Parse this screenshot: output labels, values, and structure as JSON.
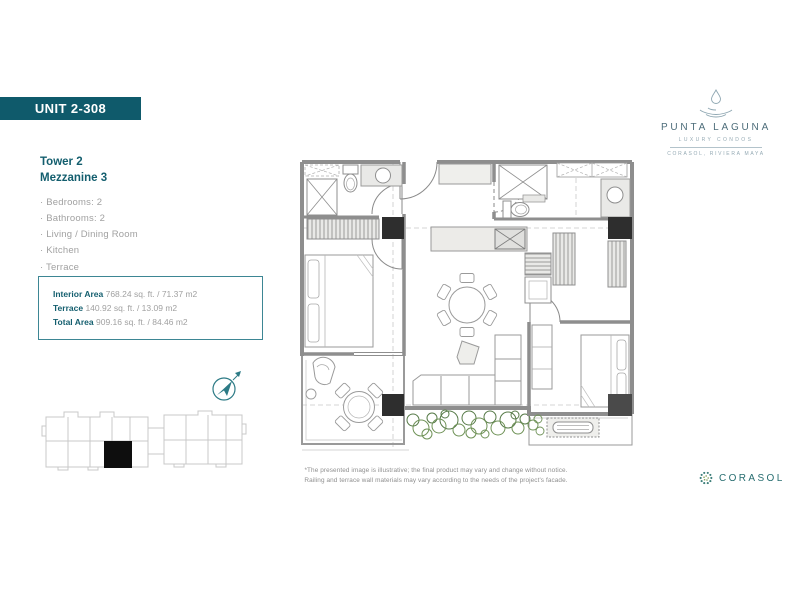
{
  "banner": {
    "label": "UNIT 2-308"
  },
  "brand": {
    "name": "PUNTA LAGUNA",
    "tagline": "LUXURY CONDOS",
    "location": "CORASOL, RIVIERA MAYA"
  },
  "unit_info": {
    "tower": "Tower 2",
    "level": "Mezzanine 3",
    "features": [
      "Bedrooms: 2",
      "Bathrooms: 2",
      "Living / Dining Room",
      "Kitchen",
      "Terrace"
    ]
  },
  "areas": {
    "rows": [
      {
        "label": "Interior Area",
        "value": " 768.24 sq. ft. / 71.37 m2"
      },
      {
        "label": "Terrace",
        "value": " 140.92 sq. ft. / 13.09 m2"
      },
      {
        "label": "Total Area",
        "value": " 909.16 sq. ft. / 84.46 m2"
      }
    ]
  },
  "disclaimer": {
    "line1": "*The presented image is illustrative; the final product may vary and change without notice.",
    "line2": "Railing and terrace wall materials may vary according to the needs of the project's facade."
  },
  "footer": {
    "brand": "CORASOL"
  },
  "colors": {
    "teal": "#0f5a6b",
    "accent_border": "#3d8694",
    "text_gray": "#a1a1a1",
    "wall_gray": "#8e8e8e",
    "column_black": "#2e2e2e",
    "plant_green": "#5e7f4e"
  }
}
